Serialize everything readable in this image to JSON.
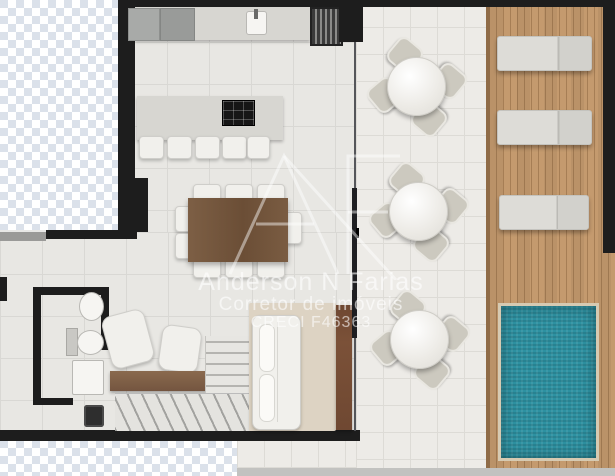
{
  "watermark": {
    "logo": "AF",
    "name": "Anderson N Farias",
    "role": "Corretor de imóveis",
    "creci": "CRECI F46363"
  },
  "colors": {
    "pool_water": "#2d91a1",
    "deck_wood": "#c0966a",
    "wall": "#1d1d1d",
    "interior_floor": "#e8e7e3",
    "terrace_floor": "#edebe7",
    "transparency_checker": "#dbe1ea",
    "dining_table_wood": "#75573e",
    "watermark_text_rgba": "rgba(255,255,255,0.55)"
  }
}
